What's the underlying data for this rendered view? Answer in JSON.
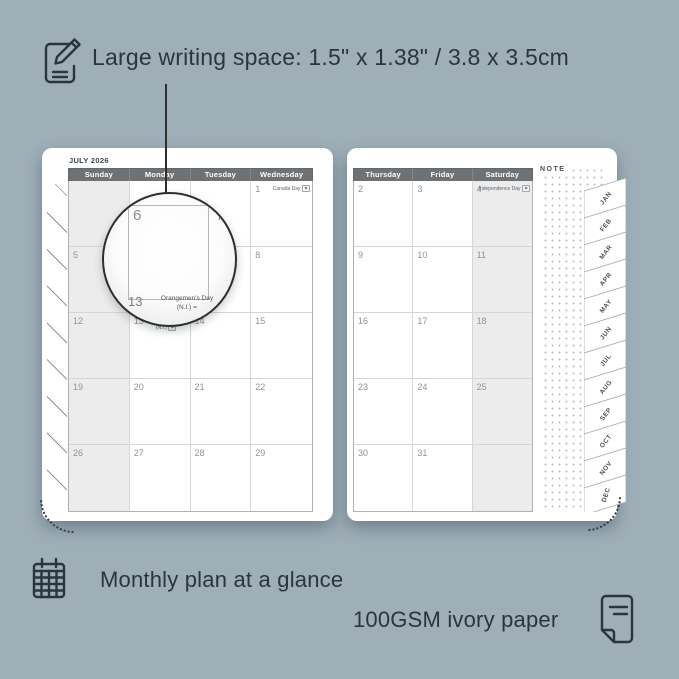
{
  "colors": {
    "background": "#9fafb8",
    "ink": "#2a363e",
    "header_bar": "#6e7275",
    "weekend_shade": "#ececec",
    "page": "#ffffff"
  },
  "annotations": {
    "top_label": "Large writing space: 1.5\" x 1.38\" / 3.8 x 3.5cm",
    "bottom_left_label": "Monthly plan at a glance",
    "bottom_right_label": "100GSM ivory paper"
  },
  "planner": {
    "month_title": "JULY 2026",
    "note_label": "NOTE",
    "left_page_days": [
      "Sunday",
      "Monday",
      "Tuesday",
      "Wednesday"
    ],
    "right_page_days": [
      "Thursday",
      "Friday",
      "Saturday"
    ],
    "left_page_rows": [
      [
        "",
        "",
        "",
        "1"
      ],
      [
        "5",
        "6",
        "7",
        "8"
      ],
      [
        "12",
        "13",
        "14",
        "15"
      ],
      [
        "19",
        "20",
        "21",
        "22"
      ],
      [
        "26",
        "27",
        "28",
        "29"
      ]
    ],
    "right_page_rows": [
      [
        "2",
        "3",
        "4"
      ],
      [
        "9",
        "10",
        "11"
      ],
      [
        "16",
        "17",
        "18"
      ],
      [
        "23",
        "24",
        "25"
      ],
      [
        "30",
        "31",
        ""
      ]
    ],
    "holidays": {
      "1": {
        "name": "Canada Day",
        "layout": "inline"
      },
      "4": {
        "name": "Independence Day",
        "layout": "inline"
      },
      "13": {
        "name": "Orangemen's Day (N.I.)",
        "layout": "stack"
      }
    },
    "flag_glyph": "⚑",
    "month_tabs": [
      "JAN",
      "FEB",
      "MAR",
      "APR",
      "MAY",
      "JUN",
      "JUL",
      "AUG",
      "SEP",
      "OCT",
      "NOV",
      "DEC"
    ],
    "magnifier": {
      "day_left": "6",
      "day_right": "7",
      "day_bottom": "13",
      "holiday_line1": "Orangemen's Day",
      "holiday_line2": "(N.I.)"
    }
  }
}
